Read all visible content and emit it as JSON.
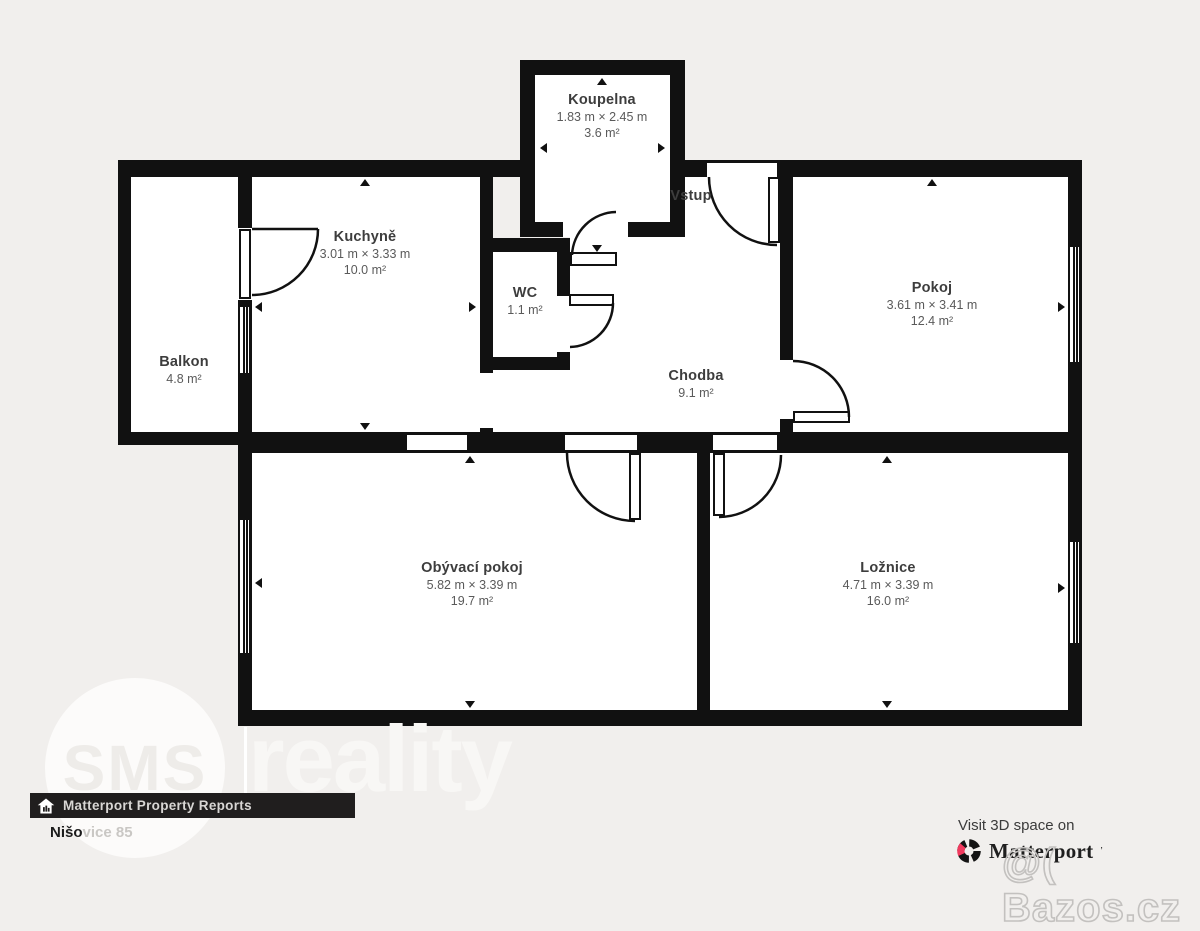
{
  "plan": {
    "entrance_label": "Vstup",
    "rooms": [
      {
        "name": "Koupelna",
        "dims": "1.83 m × 2.45 m",
        "area": "3.6 m²"
      },
      {
        "name": "Kuchyně",
        "dims": "3.01 m × 3.33 m",
        "area": "10.0 m²"
      },
      {
        "name": "WC",
        "area": "1.1 m²"
      },
      {
        "name": "Pokoj",
        "dims": "3.61 m × 3.41 m",
        "area": "12.4 m²"
      },
      {
        "name": "Balkon",
        "area": "4.8 m²"
      },
      {
        "name": "Chodba",
        "area": "9.1 m²"
      },
      {
        "name": "Obývací pokoj",
        "dims": "5.82 m × 3.39 m",
        "area": "19.7 m²"
      },
      {
        "name": "Ložnice",
        "dims": "4.71 m × 3.39 m",
        "area": "16.0 m²"
      }
    ]
  },
  "branding": {
    "sms": "SMS",
    "reality": "reality",
    "matterport_bar": "Matterport Property Reports",
    "address_dark": "Nišo",
    "address_light": "vice 85",
    "visit": "Visit 3D space on",
    "matterport": "Matterport",
    "matterport_mark": "’",
    "watermark": "@( Bazos.cz"
  },
  "colors": {
    "wall": "#111111",
    "background": "#f1efed",
    "room": "#ffffff",
    "matterport_red": "#f13a5e",
    "bar": "#201e1e"
  }
}
